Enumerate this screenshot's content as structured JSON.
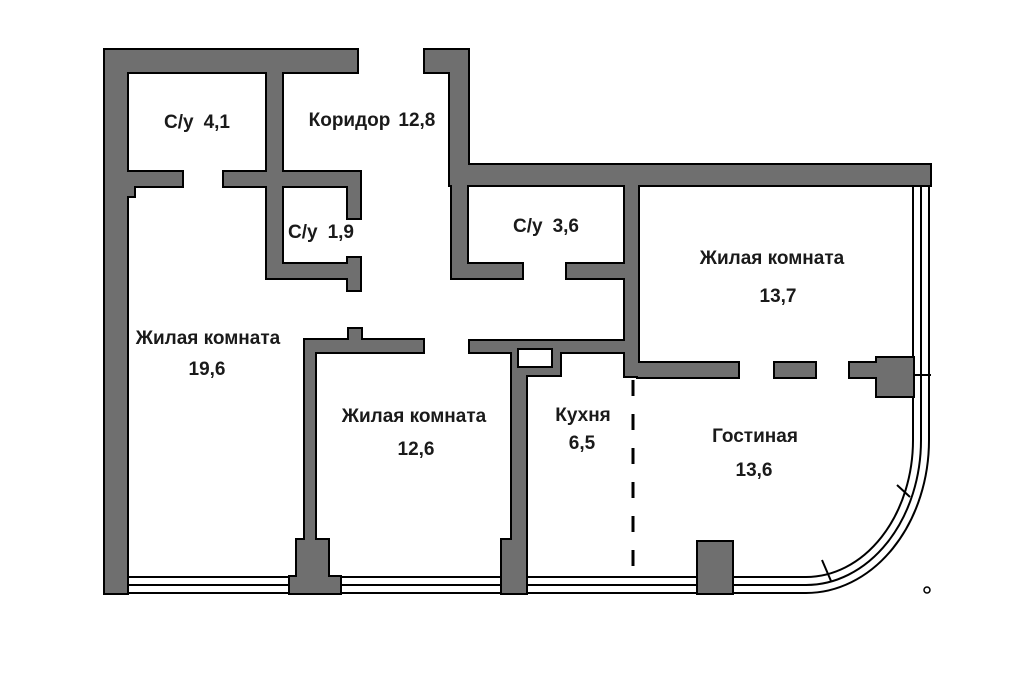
{
  "colors": {
    "wall_fill": "#6f6f6f",
    "wall_stroke": "#000000",
    "text": "#1a1a1a",
    "background": "#ffffff"
  },
  "rooms": [
    {
      "name": "С/у",
      "area": "4,1"
    },
    {
      "name": "Коридор",
      "area": "12,8"
    },
    {
      "name": "С/у",
      "area": "1,9"
    },
    {
      "name": "С/у",
      "area": "3,6"
    },
    {
      "name": "Жилая комната",
      "area": "13,7"
    },
    {
      "name": "Жилая комната",
      "area": "19,6"
    },
    {
      "name": "Жилая комната",
      "area": "12,6"
    },
    {
      "name": "Кухня",
      "area": "6,5"
    },
    {
      "name": "Гостиная",
      "area": "13,6"
    }
  ]
}
